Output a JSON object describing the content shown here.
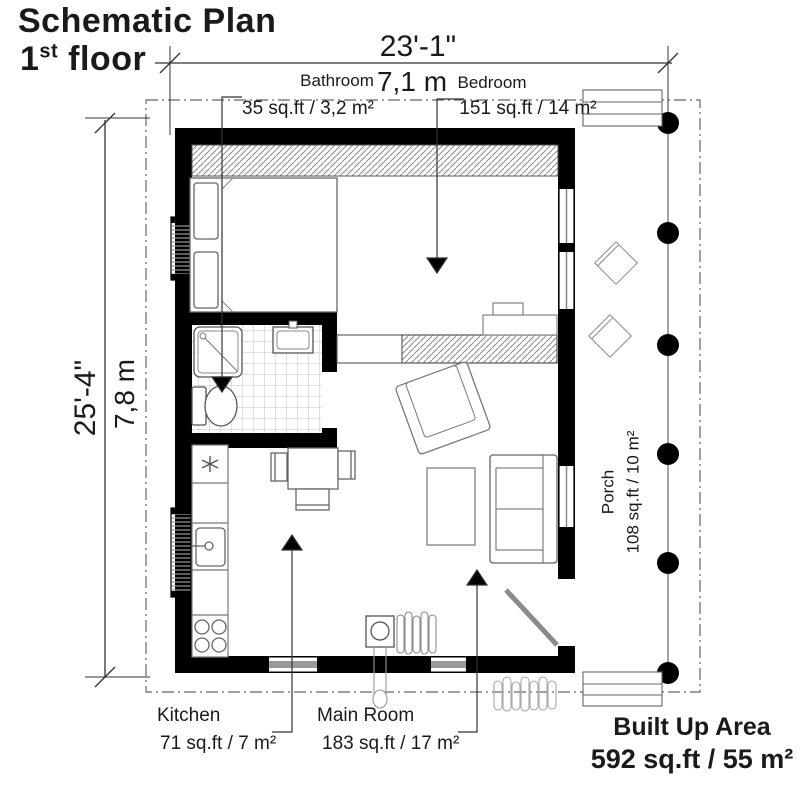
{
  "title": {
    "line1": "Schematic Plan",
    "floor_number": "1",
    "floor_suffix": "st",
    "floor_word": " floor"
  },
  "dimensions": {
    "width_ft": "23'-1\"",
    "width_m": "7,1 m",
    "height_ft": "25'-4\"",
    "height_m": "7,8 m"
  },
  "rooms": {
    "bathroom": {
      "name": "Bathroom",
      "area": "35 sq.ft / 3,2 m²"
    },
    "bedroom": {
      "name": "Bedroom",
      "area": "151 sq.ft / 14 m²"
    },
    "kitchen": {
      "name": "Kitchen",
      "area": "71 sq.ft / 7 m²"
    },
    "main_room": {
      "name": "Main Room",
      "area": "183 sq.ft / 17 m²"
    },
    "porch": {
      "name": "Porch",
      "area": "108 sq.ft / 10 m²"
    }
  },
  "built_up": {
    "label": "Built Up Area",
    "value": "592 sq.ft / 55 m²"
  },
  "colors": {
    "wall": "#000000",
    "line_dark": "#333333",
    "line_mid": "#777777",
    "line_light": "#aaaaaa",
    "door_swing": "#8a8a8a"
  }
}
